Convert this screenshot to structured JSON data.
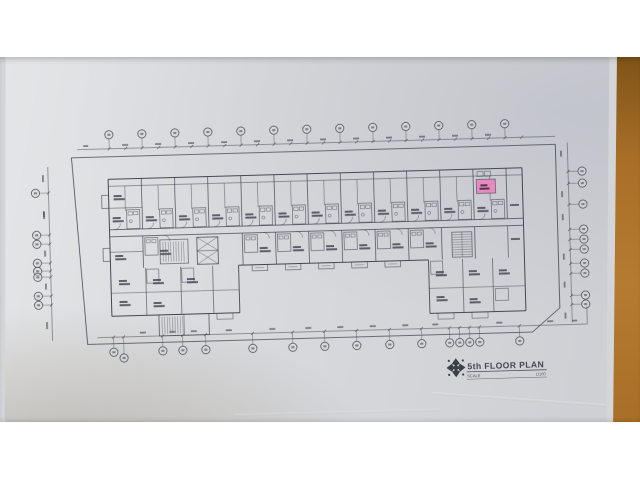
{
  "scene": {
    "letterbox_color": "#ffffff",
    "surface": {
      "name": "wooden-desk-surface",
      "color": "#a96f28",
      "color_dark": "#7f5417",
      "color_light": "#b57b31"
    },
    "paper": {
      "name": "printed-floor-plan-sheet",
      "color": "#d9dadd",
      "edge_color": "#d4d5d8"
    }
  },
  "drawing": {
    "line_color": "#3c414c",
    "title_block": {
      "logo": "rosette-compass-icon",
      "title": "5th FLOOR PLAN",
      "scale_label": "SCALE",
      "scale_value": "1/100"
    },
    "highlighted_unit": {
      "color": "#ea85c2"
    },
    "grid_bubbles": {
      "top": 13,
      "bottom": 16,
      "left": 8,
      "right": 10
    },
    "unit_modules": {
      "top_row": 12,
      "middle_row": 10
    }
  }
}
